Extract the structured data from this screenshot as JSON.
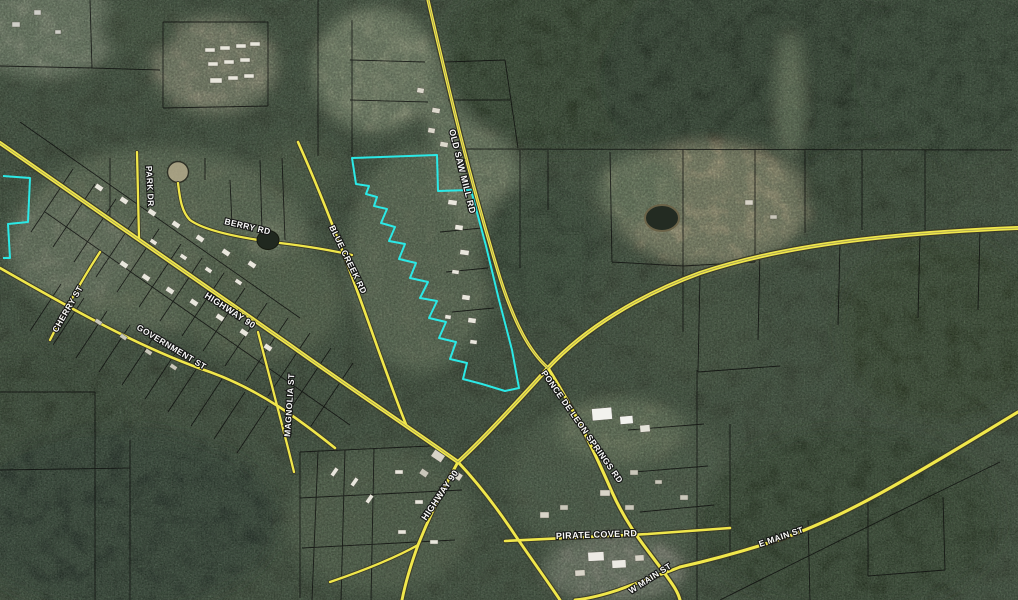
{
  "map": {
    "description": "Aerial parcel (GIS) map with highlighted parcel selection",
    "road_labels": [
      {
        "id": "old-saw-mill-rd",
        "label": "OLD SAW MILL RD"
      },
      {
        "id": "park-dr",
        "label": "PARK DR"
      },
      {
        "id": "berry-rd",
        "label": "BERRY RD"
      },
      {
        "id": "cherry-st",
        "label": "CHERRY ST"
      },
      {
        "id": "highway-90-west",
        "label": "HIGHWAY 90"
      },
      {
        "id": "government-st",
        "label": "GOVERNMENT ST"
      },
      {
        "id": "magnolia-st",
        "label": "MAGNOLIA ST"
      },
      {
        "id": "blue-creek-rd",
        "label": "BLUE CREEK RD"
      },
      {
        "id": "ponce-de-leon-springs-rd",
        "label": "PONCE DE LEON SPRINGS RD"
      },
      {
        "id": "highway-90-south",
        "label": "HIGHWAY 90"
      },
      {
        "id": "pirate-cove-rd",
        "label": "PIRATE COVE RD"
      },
      {
        "id": "e-main-st",
        "label": "E MAIN ST"
      },
      {
        "id": "w-main-st",
        "label": "W MAIN ST"
      }
    ],
    "colors": {
      "road_fill": "#f0e74b",
      "road_casing": "#3b3b2b",
      "parcel_line": "#0d0d0d",
      "selection_highlight": "#2be9e6",
      "label_text": "#ffffff"
    }
  }
}
